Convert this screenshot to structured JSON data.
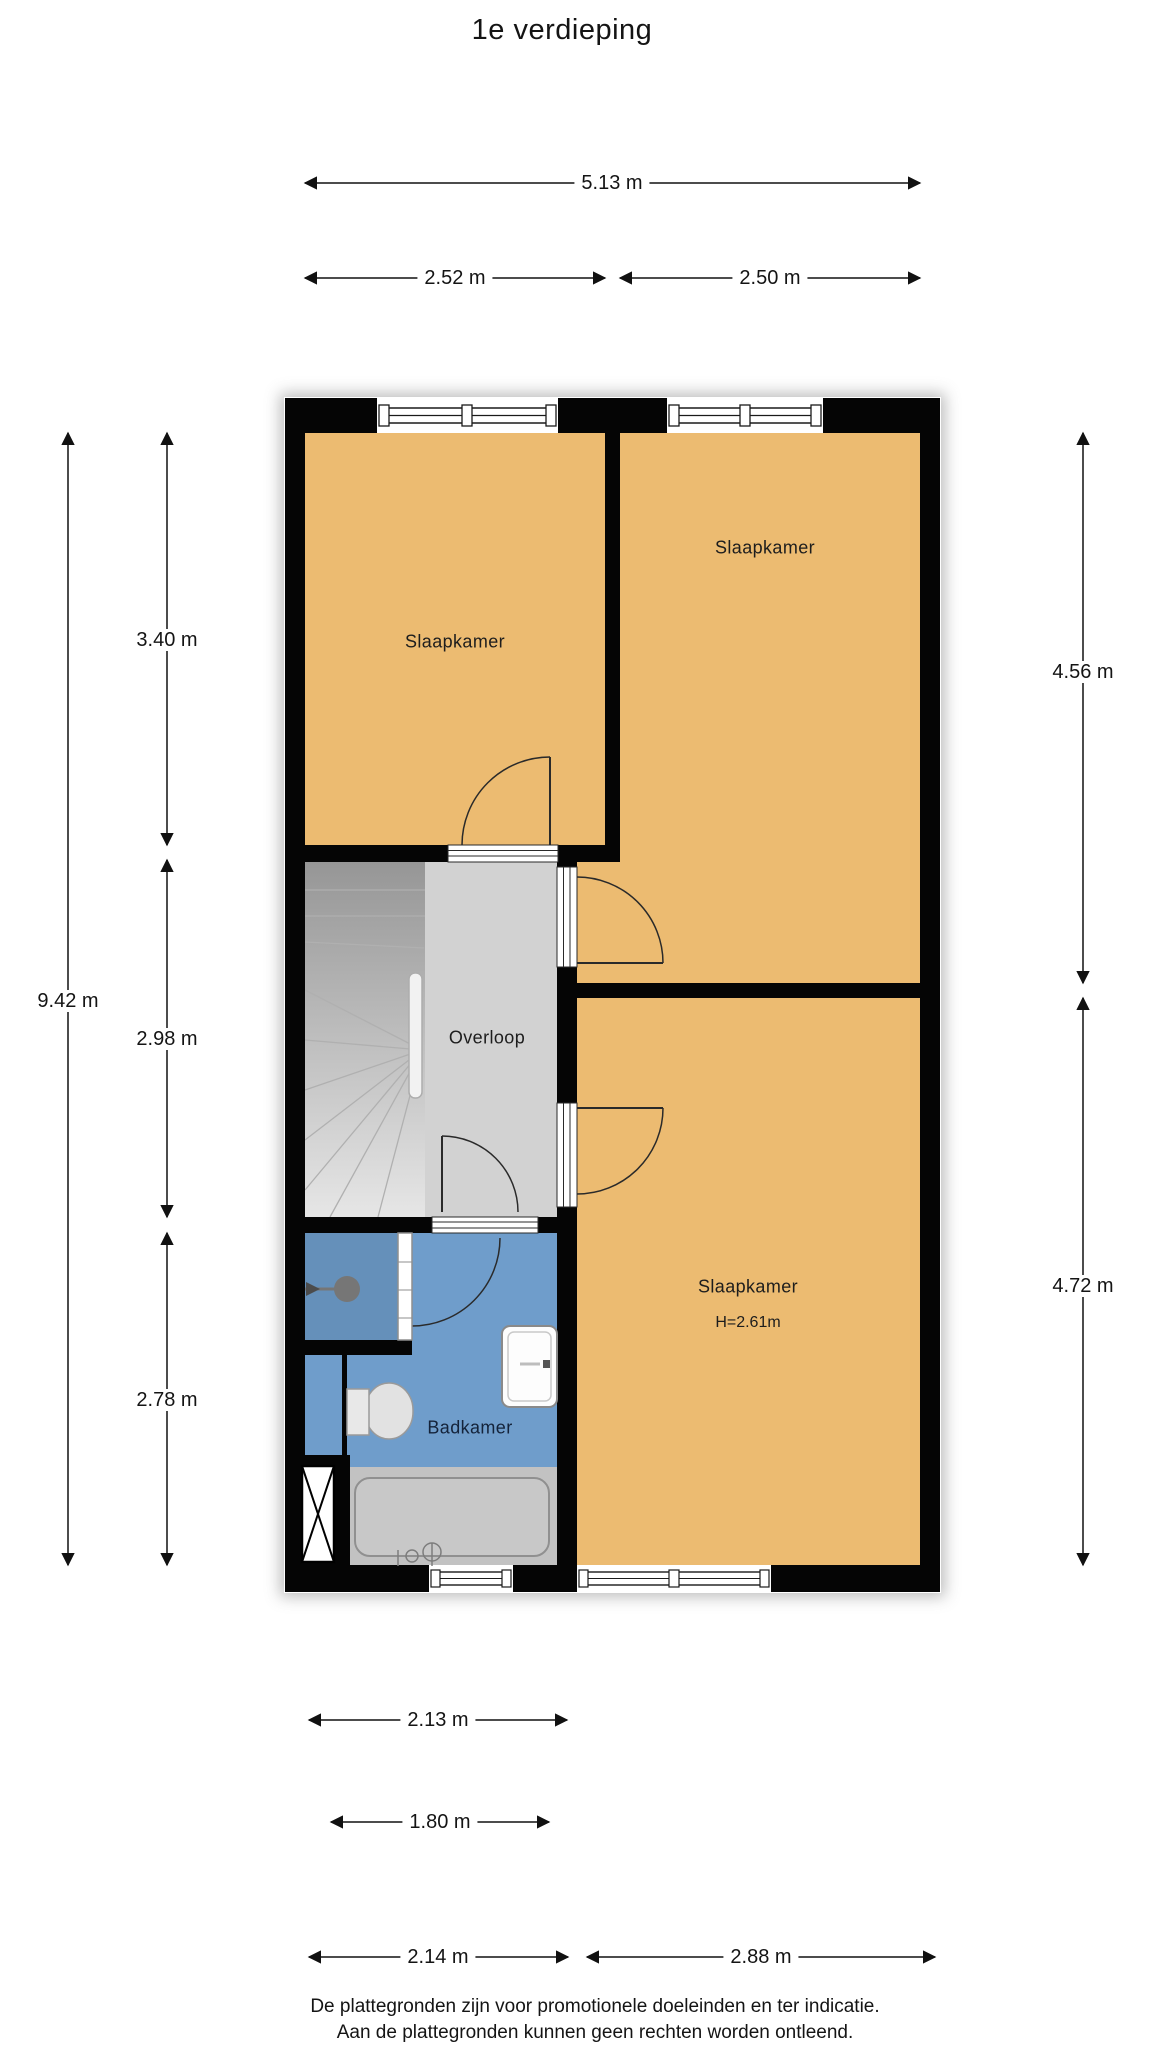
{
  "title": "1e verdieping",
  "rooms": {
    "bedroom_top_left": {
      "label": "Slaapkamer"
    },
    "bedroom_top_right": {
      "label": "Slaapkamer"
    },
    "bedroom_bottom_right": {
      "label": "Slaapkamer",
      "height_note": "H=2.61m"
    },
    "hallway": {
      "label": "Overloop"
    },
    "bathroom": {
      "label": "Badkamer"
    }
  },
  "dimensions": {
    "top_total": "5.13 m",
    "top_left": "2.52 m",
    "top_right": "2.50 m",
    "left_total": "9.42 m",
    "left_top": "3.40 m",
    "left_middle": "2.98 m",
    "left_bottom": "2.78 m",
    "right_top": "4.56 m",
    "right_bottom": "4.72 m",
    "bottom_row1": "2.13 m",
    "bottom_row2": "1.80 m",
    "bottom_row3_left": "2.14 m",
    "bottom_row3_right": "2.88 m"
  },
  "footer": {
    "line1": "De plattegronden zijn voor promotionele doeleinden en ter indicatie.",
    "line2": "Aan de plattegronden kunnen geen rechten worden ontleend."
  },
  "colors": {
    "room_fill": "#ecbb71",
    "hallway_fill": "#d2d2d2",
    "stairs_dark": "#969696",
    "stairs_light": "#e6e6e6",
    "bathroom_fill": "#6f9dcb",
    "shower_fill": "#6590ba",
    "tub_zone_fill": "#c2c2c2",
    "wall": "#050505"
  }
}
